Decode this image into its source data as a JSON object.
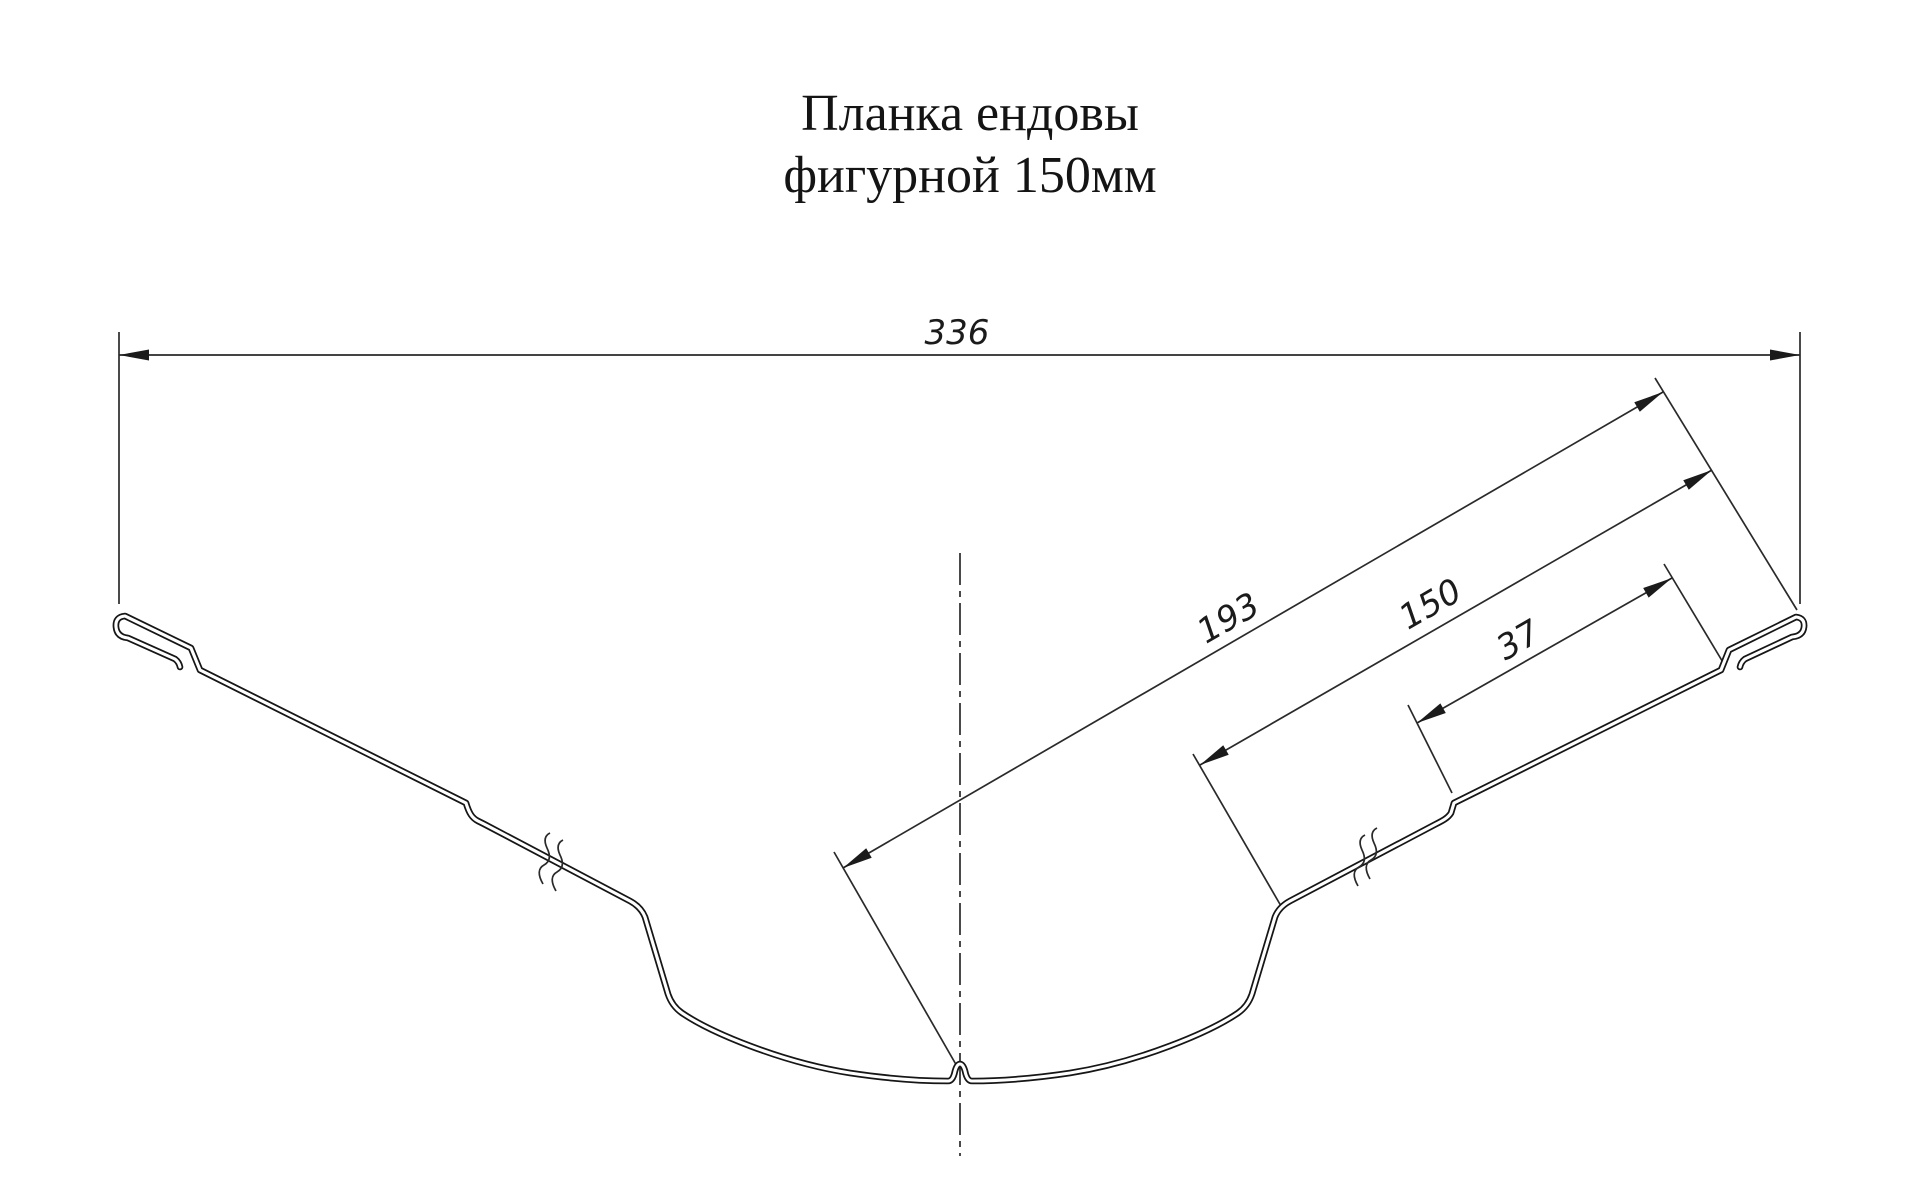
{
  "title": {
    "line1": "Планка ендовы",
    "line2": "фигурной 150мм"
  },
  "dimensions": {
    "overall_width": "336",
    "valley_to_edge": "193",
    "slope_width": "150",
    "rib_to_edge": "37"
  },
  "drawing": {
    "kind": "profile-section-technical-drawing",
    "line_color": "#1b1b1b",
    "background_color": "#ffffff"
  }
}
